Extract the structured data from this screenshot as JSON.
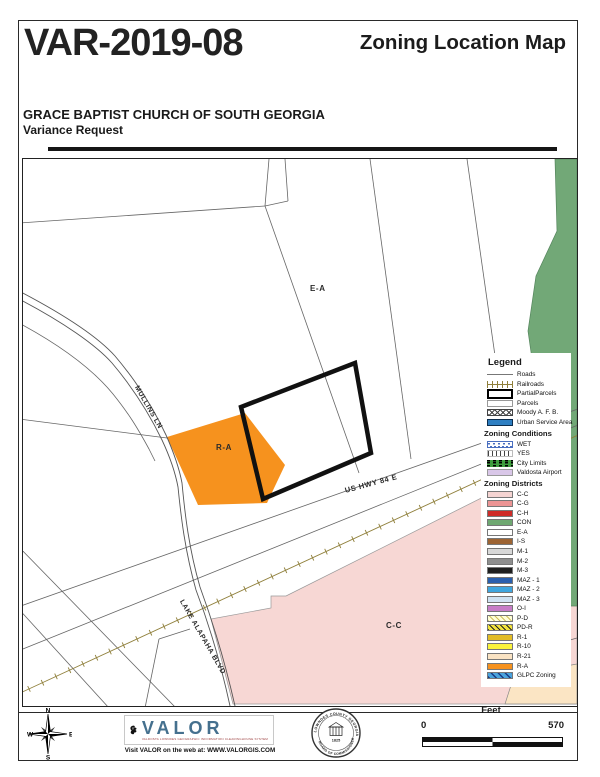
{
  "header": {
    "case_number": "VAR-2019-08",
    "map_title": "Zoning Location Map",
    "applicant": "GRACE BAPTIST CHURCH OF SOUTH GEORGIA",
    "request_type": "Variance Request"
  },
  "map": {
    "labels": [
      {
        "text": "E-A",
        "x": 287,
        "y": 125,
        "rot": 0,
        "size": 8
      },
      {
        "text": "R-A",
        "x": 193,
        "y": 284,
        "rot": 0,
        "size": 8
      },
      {
        "text": "C-C",
        "x": 363,
        "y": 462,
        "rot": 0,
        "size": 8
      },
      {
        "text": "R-21",
        "x": 521,
        "y": 506,
        "rot": -10,
        "size": 7
      },
      {
        "text": "US HWY 84 E",
        "x": 322,
        "y": 327,
        "rot": -15,
        "size": 7.5
      },
      {
        "text": "MULLINS LN",
        "x": 113,
        "y": 224,
        "rot": 60,
        "size": 7
      },
      {
        "text": "LAKE ALAPAHA BLVD",
        "x": 158,
        "y": 438,
        "rot": 60,
        "size": 7
      },
      {
        "text": "RIVE:",
        "x": 494,
        "y": 492,
        "rot": -17,
        "size": 7
      }
    ]
  },
  "legend": {
    "title": "Legend",
    "sections": [
      {
        "heading": "",
        "items": [
          {
            "label": "Roads",
            "sym": "roads"
          },
          {
            "label": "Railroads",
            "sym": "railroads"
          },
          {
            "label": "PartialParcels",
            "sym": "partial"
          },
          {
            "label": "Parcels",
            "sym": "parcels"
          },
          {
            "label": "Moody A. F. B.",
            "sym": "moody"
          },
          {
            "label": "Urban Service Area",
            "sym": "urban"
          }
        ]
      },
      {
        "heading": "Zoning Conditions",
        "items": [
          {
            "label": "WET",
            "sym": "wet"
          },
          {
            "label": "YES",
            "sym": "yes"
          },
          {
            "label": "City Limits",
            "sym": "city"
          },
          {
            "label": "Valdosta Airport",
            "sym": "airport"
          }
        ]
      },
      {
        "heading": "Zoning Districts",
        "items": [
          {
            "label": "C-C",
            "color": "#f5d4d2"
          },
          {
            "label": "C-G",
            "color": "#ec9494"
          },
          {
            "label": "C-H",
            "color": "#ce2b28"
          },
          {
            "label": "CON",
            "color": "#6fa871"
          },
          {
            "label": "E-A",
            "color": "#ffffff"
          },
          {
            "label": "I-S",
            "color": "#9d6433"
          },
          {
            "label": "M-1",
            "color": "#d8d8d8"
          },
          {
            "label": "M-2",
            "color": "#8e8e8e"
          },
          {
            "label": "M-3",
            "color": "#1f1f1f"
          },
          {
            "label": "MAZ - 1",
            "color": "#2a5fae"
          },
          {
            "label": "MAZ - 2",
            "color": "#3fa6df"
          },
          {
            "label": "MAZ - 3",
            "color": "#cfe2f2"
          },
          {
            "label": "O-I",
            "color": "#c77dc7"
          },
          {
            "label": "P-D",
            "color": "#ffffd8",
            "sym": "pd"
          },
          {
            "label": "PD-R",
            "color": "#f2e33c",
            "sym": "pdr"
          },
          {
            "label": "R-1",
            "color": "#e2bc25"
          },
          {
            "label": "R-10",
            "color": "#fbf33c"
          },
          {
            "label": "R-21",
            "color": "#fae3c3"
          },
          {
            "label": "R-A",
            "color": "#f6921e"
          },
          {
            "label": "GLPC Zoning",
            "color": "#4aa3dc",
            "sym": "glpc"
          }
        ]
      }
    ]
  },
  "footer": {
    "compass": {
      "north": "N",
      "east": "E",
      "south": "S",
      "west": "W"
    },
    "valor": {
      "name": "VALOR",
      "tagline": "VALDOSTA LOWNDES GEOGRAPHIC INFORMATION CLEARINGHOUSE SYSTEM",
      "web": "Visit VALOR on the web at: WWW.VALORGIS.COM"
    },
    "seal": {
      "top_text": "LOWNDES COUNTY GEORGIA",
      "bottom_text": "BOARD OF COMMISSIONERS",
      "year": "1825"
    },
    "scale": {
      "unit": "Feet",
      "start": "0",
      "end": "570"
    }
  },
  "colors": {
    "r_a_orange": "#f6921e",
    "c_c_pink": "#f7d7d4",
    "con_green": "#72a877",
    "r21_beige": "#fbe5c4",
    "railroad": "#8f7f3a",
    "valor_blue": "#45708e"
  }
}
